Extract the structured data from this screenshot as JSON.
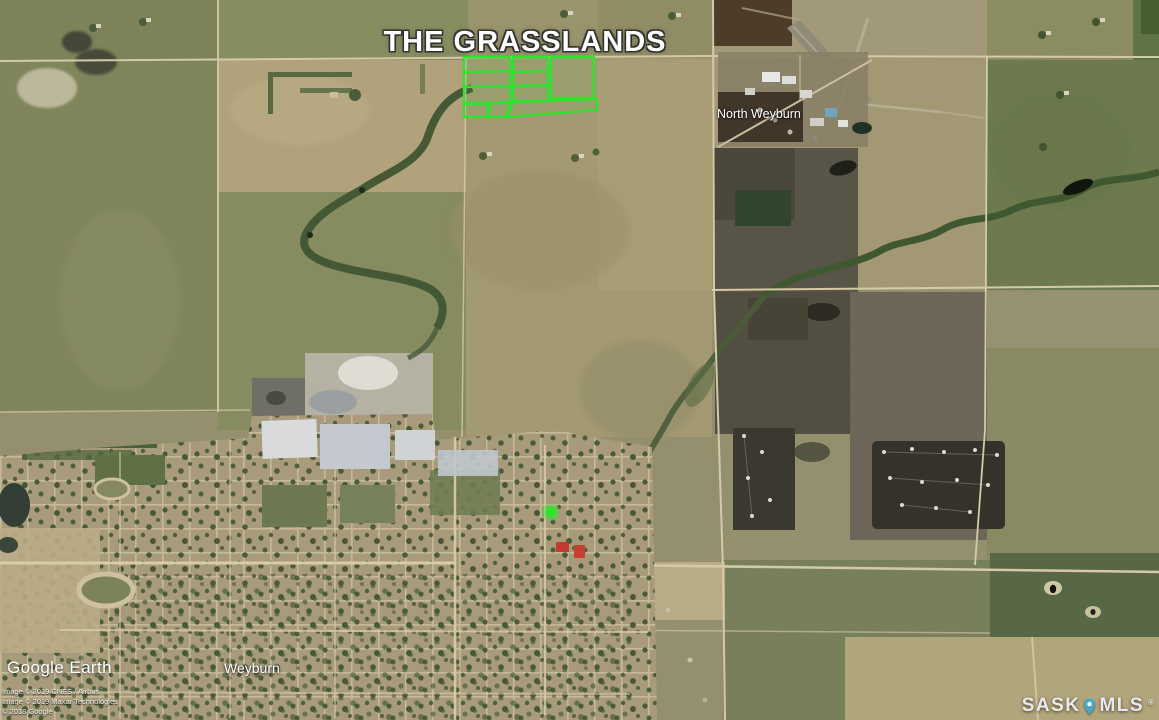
{
  "map": {
    "title": "THE GRASSLANDS",
    "labels": {
      "north_weyburn": "North Weyburn",
      "weyburn": "Weyburn"
    },
    "watermark": "Google Earth",
    "copyright_lines": [
      "Image © 2019 CNES / Airbus",
      "Image © 2019 Maxar Technologies",
      "© 2018 Google"
    ],
    "brand": {
      "sask": "SASK",
      "mls": "MLS",
      "registered": "®"
    },
    "annotations": {
      "parcel_outline_color": "#2fe32f",
      "marker_color": "#2ee52e"
    },
    "brand_pin_color": "#45a9c8"
  }
}
